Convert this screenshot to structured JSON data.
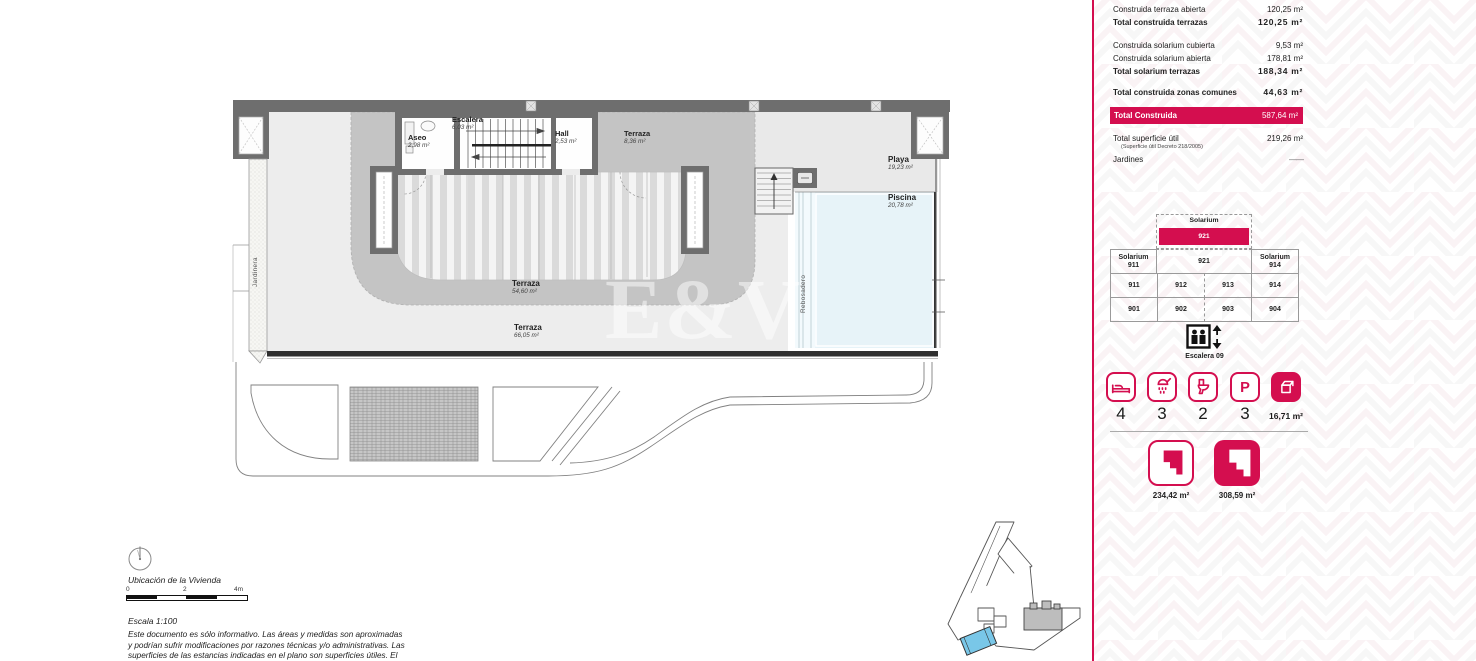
{
  "accent": "#D40E4F",
  "sidebar": {
    "measurements": [
      {
        "label": "Construida terraza abierta",
        "value": "120,25 m²"
      },
      {
        "label": "Total construida terrazas",
        "value": "120,25 m²"
      },
      {
        "label": "Construida solarium cubierta",
        "value": "9,53 m²"
      },
      {
        "label": "Construida solarium abierta",
        "value": "178,81 m²"
      },
      {
        "label": "Total solarium terrazas",
        "value": "188,34 m²"
      },
      {
        "label": "Total construida zonas comunes",
        "value": "44,63 m²"
      }
    ],
    "total": {
      "label": "Total Construida",
      "value": "587,64 m²"
    },
    "util": {
      "label": "Total superficie útil",
      "sub": "(Superficie útil Decreto 218/2005)",
      "value": "219,26 m²"
    },
    "jardines": {
      "label": "Jardines",
      "value": "——"
    },
    "selector": {
      "top_label": "Solarium",
      "top_unit": "921",
      "mid_left_line1": "Solarium",
      "mid_left_line2": "911",
      "mid_center": "921",
      "mid_right_line1": "Solarium",
      "mid_right_line2": "914",
      "row2": [
        "911",
        "912",
        "913",
        "914"
      ],
      "row3": [
        "901",
        "902",
        "903",
        "904"
      ],
      "stairs_label": "Escalera 09"
    },
    "features": [
      {
        "name": "bedrooms",
        "value": "4"
      },
      {
        "name": "bathrooms",
        "value": "3"
      },
      {
        "name": "toilets",
        "value": "2"
      },
      {
        "name": "parking",
        "value": "3",
        "glyph": "P"
      },
      {
        "name": "storage",
        "value": "16,71 m²"
      }
    ],
    "plans": [
      {
        "value": "234,42 m²"
      },
      {
        "value": "308,59 m²"
      }
    ]
  },
  "plan": {
    "rooms": {
      "aseo": {
        "name": "Aseo",
        "area": "2,98 m²"
      },
      "escalera": {
        "name": "Escalera",
        "area": "6,03 m²"
      },
      "hall": {
        "name": "Hall",
        "area": "2,53 m²"
      },
      "terraza_top": {
        "name": "Terraza",
        "area": "8,36 m²"
      },
      "playa": {
        "name": "Playa",
        "area": "19,23 m²"
      },
      "piscina": {
        "name": "Piscina",
        "area": "20,78 m²"
      },
      "terraza_mid": {
        "name": "Terraza",
        "area": "54,60 m²"
      },
      "terraza_low": {
        "name": "Terraza",
        "area": "66,05 m²"
      }
    },
    "jardinera": "Jardinera",
    "rebosadero": "Rebosadero",
    "watermark": "E&V"
  },
  "footer": {
    "location_label": "Ubicación de la Vivienda",
    "scale_ticks": [
      "0",
      "2",
      "4m"
    ],
    "scale_label": "Escala 1:100",
    "disclaimer": [
      "Este documento es sólo informativo. Las áreas y medidas son aproximadas",
      "y podrían sufrir modificaciones por razones técnicas y/o administrativas. Las",
      "superficies de las estancias indicadas en el plano son superficies útiles. El"
    ]
  }
}
